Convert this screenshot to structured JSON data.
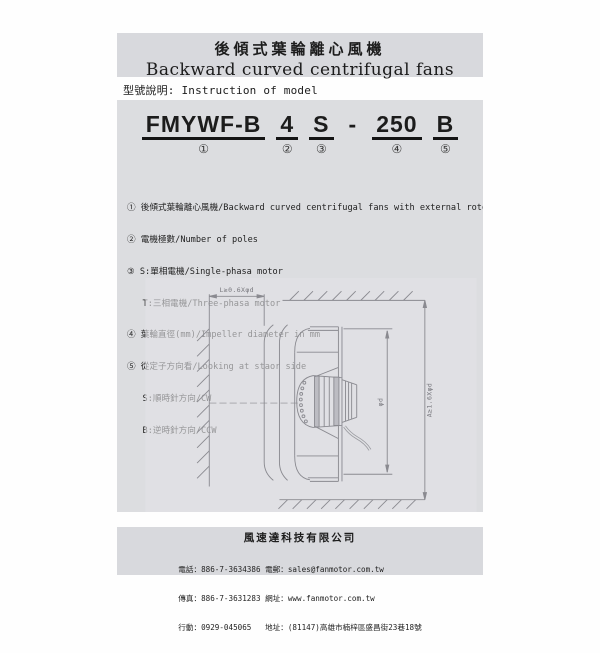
{
  "header": {
    "title_zh": "後傾式葉輪離心風機",
    "title_en": "Backward curved centrifugal fans"
  },
  "section": {
    "label": "型號說明: Instruction of model"
  },
  "model": {
    "segments": [
      {
        "text": "FMYWF-B",
        "num": "①"
      },
      {
        "text": "4",
        "num": "②"
      },
      {
        "text": "S",
        "num": "③"
      },
      {
        "text": "-",
        "num": ""
      },
      {
        "text": "250",
        "num": "④"
      },
      {
        "text": "B",
        "num": "⑤"
      }
    ]
  },
  "legend": {
    "items": [
      "① 後傾式葉輪離心風機/Backward curved centrifugal fans with external rotor motor",
      "② 電機極數/Number of poles",
      "③ S:單相電機/Single-phasa motor",
      "   T:三相電機/Three-phasa motor",
      "④ 葉輪直徑(mm)/Impeller diameter in mm",
      "⑤ 從定子方向看/Looking at staor side",
      "   S:順時針方向/CW",
      "   B:逆時針方向/CCW"
    ]
  },
  "drawing": {
    "dim_l": "L≥0.6Xφd",
    "dim_a": "A≥1.6Xφd",
    "dim_d": "φd"
  },
  "footer": {
    "company": "風速達科技有限公司",
    "lines": [
      "電話：886-7-3634386 電郵：sales@fanmotor.com.tw",
      "傳真：886-7-3631283 網址：www.fanmotor.com.tw",
      "行動：0929-045065   地址：(81147)高雄市楠梓區盛昌街23巷18號"
    ]
  },
  "colors": {
    "page_bg": "#fefefe",
    "band_bg": "#d8d9dd",
    "block_bg": "#dcdde0",
    "text": "#1c1c1c",
    "drawing_line": "#8a8a90"
  }
}
